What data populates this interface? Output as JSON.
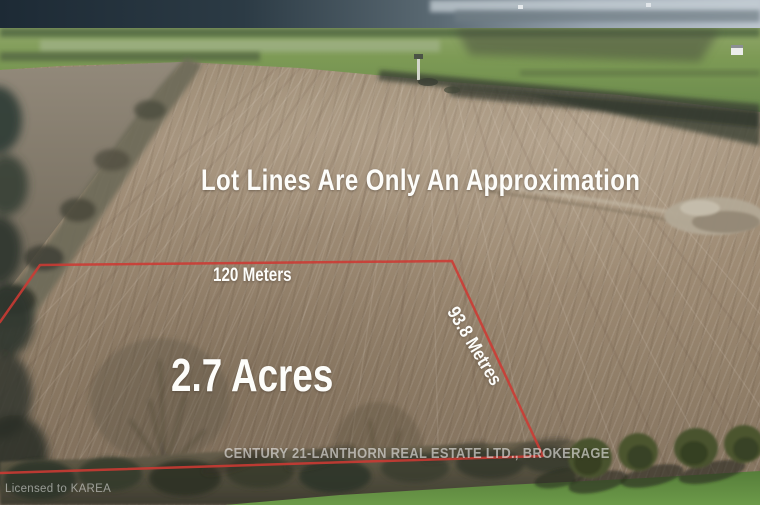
{
  "overlay": {
    "disclaimer": "Lot Lines Are Only An Approximation",
    "top_measure": "120 Meters",
    "area": "2.7 Acres",
    "side_measure": "93.8 Metres"
  },
  "watermarks": {
    "brokerage": "CENTURY 21-LANTHORN REAL ESTATE LTD., BROKERAGE",
    "license": "Licensed to KAREA"
  },
  "lot_outline": {
    "color": "#cd3a33",
    "points": [
      [
        0,
        322
      ],
      [
        40,
        265
      ],
      [
        452,
        261
      ],
      [
        543,
        456
      ],
      [
        0,
        473
      ]
    ]
  },
  "colors": {
    "overlay_text": "#fdfdfa",
    "watermark_text": "rgba(255,255,255,0.55)",
    "field_tan": "#9b8972",
    "green_field": "#7d9a55"
  }
}
